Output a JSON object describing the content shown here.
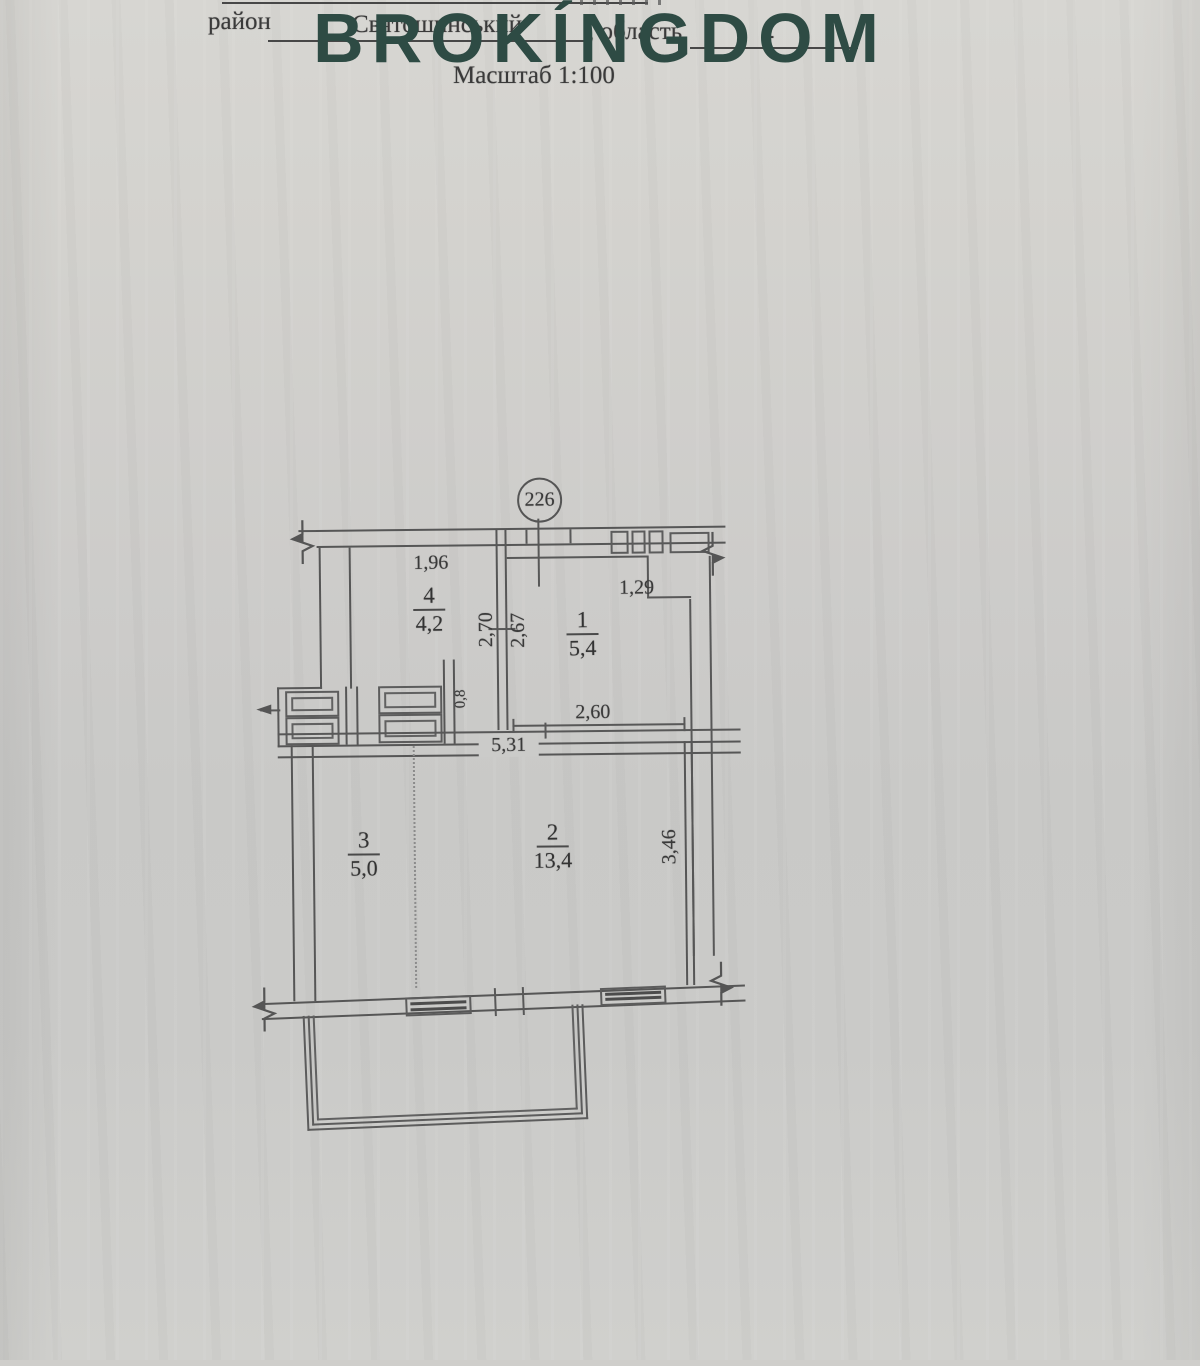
{
  "header": {
    "district_label": "район",
    "district_value": "Святошинський",
    "oblast_label": ", область",
    "oblast_value": "-",
    "scale_label": "Масштаб 1:100"
  },
  "watermark": {
    "text": "BROKÍNGDOM",
    "color": "#2e4b44"
  },
  "plan": {
    "unit_axis_number": "226",
    "rooms": [
      {
        "num": "4",
        "area": "4,2"
      },
      {
        "num": "1",
        "area": "5,4"
      },
      {
        "num": "3",
        "area": "5,0"
      },
      {
        "num": "2",
        "area": "13,4"
      }
    ],
    "dims": {
      "d196": "1,96",
      "d129": "1,29",
      "d270": "2,70",
      "d267": "2,67",
      "d08": "0,8",
      "d260": "2,60",
      "d531": "5,31",
      "d346": "3,46"
    }
  }
}
